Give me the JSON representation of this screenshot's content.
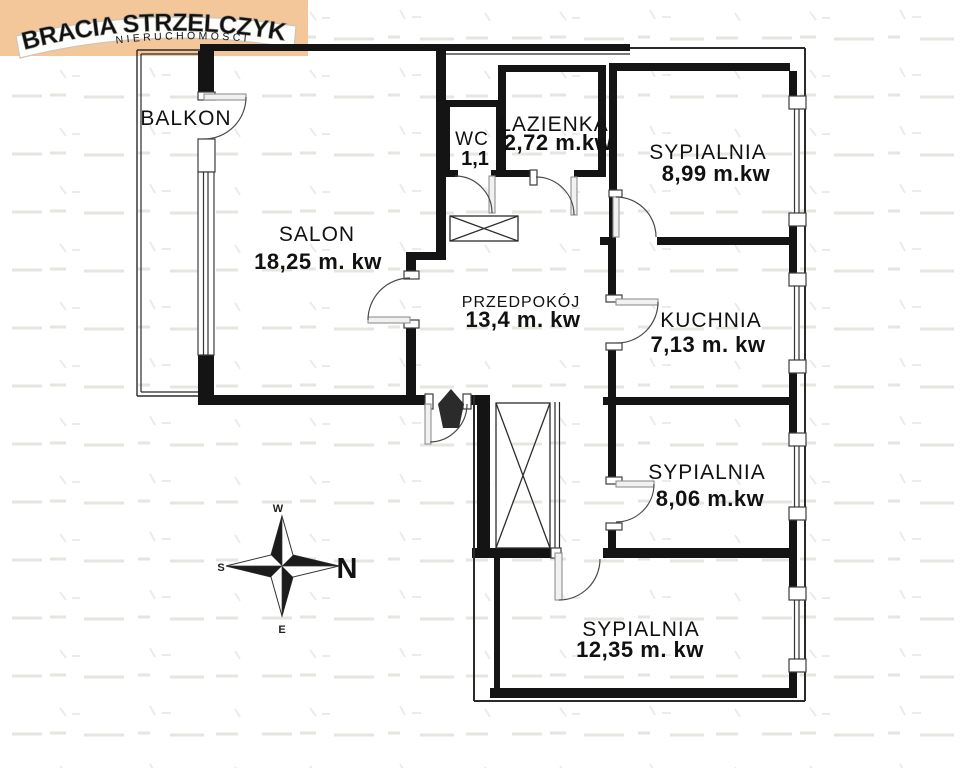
{
  "logo": {
    "brand": "BRACIA STRZELCZYK",
    "subtitle": "NIERUCHOMOŚCI",
    "bg_color": "#f4c79a",
    "text_color": "#a9a9a5"
  },
  "compass": {
    "n": "N",
    "s": "S",
    "e": "E",
    "w": "W"
  },
  "plan": {
    "rooms": {
      "balkon": {
        "name": "BALKON",
        "area": ""
      },
      "salon": {
        "name": "SALON",
        "area": "18,25 m. kw"
      },
      "wc": {
        "name": "WC",
        "area": "1,1"
      },
      "lazienka": {
        "name": "ŁAZIENKA",
        "area": "2,72 m.kw"
      },
      "sypialnia1": {
        "name": "SYPIALNIA",
        "area": "8,99 m.kw"
      },
      "przedpokoj": {
        "name": "PRZEDPOKÓJ",
        "area": "13,4 m. kw"
      },
      "kuchnia": {
        "name": "KUCHNIA",
        "area": "7,13 m. kw"
      },
      "sypialnia2": {
        "name": "SYPIALNIA",
        "area": "8,06 m.kw"
      },
      "sypialnia3": {
        "name": "SYPIALNIA",
        "area": "12,35 m. kw"
      }
    }
  }
}
